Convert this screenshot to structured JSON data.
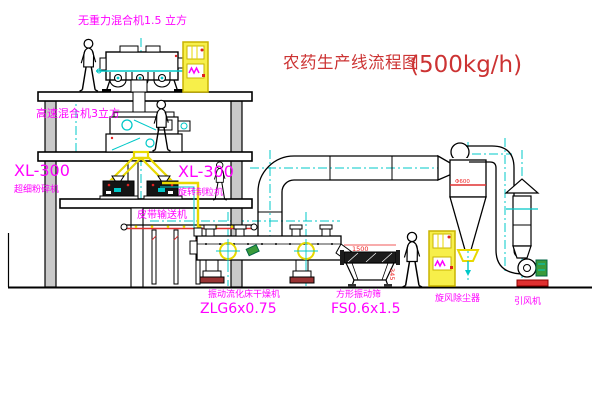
{
  "drawing": {
    "title": "农药生产线流程图",
    "capacity": "(500kg/h)"
  },
  "equipment_labels": {
    "gravity_mixer": "无重力混合机1.5 立方",
    "high_speed_mixer": "高速混合机3立方",
    "mill_model": "XL-300",
    "mill_name": "超细粉碎机",
    "granulator_model": "XL-300",
    "granulator_name": "旋转制粒机",
    "belt_conveyor": "皮带输送机",
    "dryer_name": "振动流化床干燥机",
    "dryer_model": "ZLG6x0.75",
    "sieve_name": "方形振动筛",
    "sieve_model": "FS0.6x1.5",
    "cyclone_name": "旋风除尘器",
    "fan_name": "引风机"
  },
  "dimensions": {
    "sieve_width": "1500",
    "sieve_height": "345",
    "cyclone_note": "Φ600"
  },
  "colors": {
    "label": "#ff00ff",
    "title": "#cc3333",
    "cad_yellow": "#e8d800",
    "cad_cyan": "#00c8c8",
    "dim_red": "#ee2222"
  }
}
